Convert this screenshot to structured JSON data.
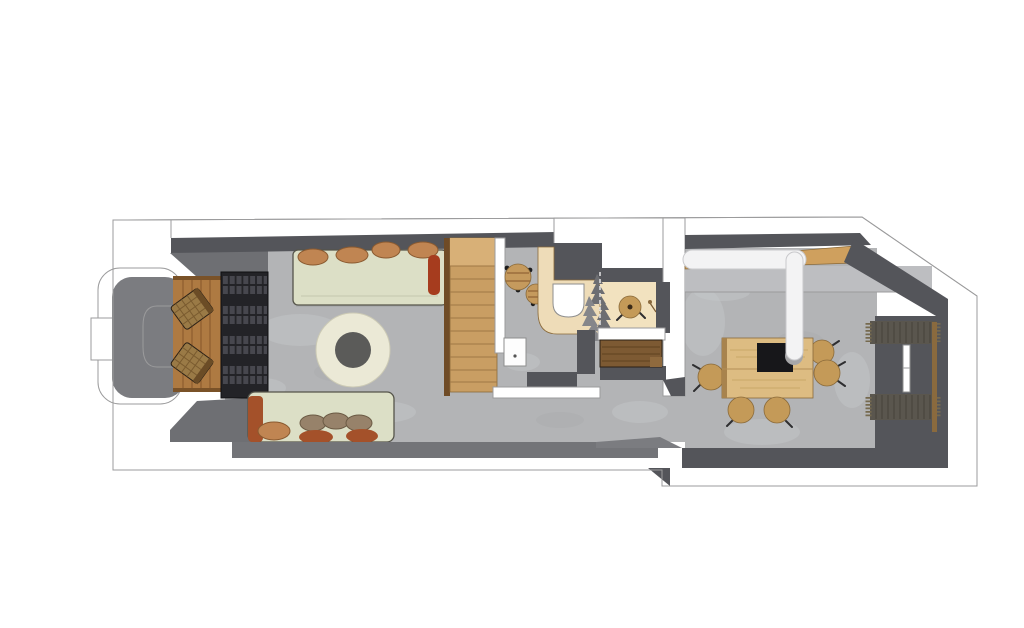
{
  "meta": {
    "type": "floor-plan",
    "style": "3d-top-down-render",
    "canvas": {
      "width": 1024,
      "height": 628
    }
  },
  "colors": {
    "white": "#FFFFFF",
    "outline_gray": "#9B9B9C",
    "wall_dark": "#54555A",
    "wall_mid": "#6E6F73",
    "wall_light": "#7B7C80",
    "wall_bottom": "#737478",
    "floor_concrete": "#B3B4B6",
    "floor_tex_light": "#C6C7C9",
    "floor_tex_dark": "#A7A8AA",
    "counter_gray": "#BDBEC1",
    "wood_strip": "#CFA05E",
    "wood_stairs": "#C99E63",
    "wood_stairs_light": "#D8B077",
    "wood_stringer": "#6F4B26",
    "wood_deck": "#AE7A42",
    "shelf_dark": "#232327",
    "shelf_cell": "#4B4B52",
    "sofa_cream": "#DCDFC6",
    "pillow_tan": "#C08552",
    "pillow_brown": "#97826A",
    "pillow_rust": "#A4512A",
    "bolster_red": "#A63C1E",
    "rug_cream": "#EBE9D6",
    "rug_center": "#5B5B59",
    "counter_wood": "#EEDCB8",
    "wood_floor_bath": "#F2E2BF",
    "table_wood": "#C59A5D",
    "stool_wood": "#C49A58",
    "bench_wood": "#7D5A33",
    "bench_wood_light": "#8F6A3E",
    "island_wood": "#DDBC82",
    "island_edge": "#A8834D",
    "stove_black": "#17171A",
    "duct_white": "#F3F3F4",
    "duct_shadow": "#A6A6A8",
    "radiator_dark": "#5A564E",
    "radiator_strip": "#8A6A3E",
    "plant_gray": "#85868A",
    "plant_gray_dark": "#6D6E72",
    "chair_rattan": "#9A7A46",
    "chair_rattan_dark": "#6B4C26",
    "appliance_white": "#FDFDFD",
    "leg_black": "#1C1C1E"
  },
  "rooms": [
    {
      "name": "entry-bay"
    },
    {
      "name": "lounge"
    },
    {
      "name": "staircase"
    },
    {
      "name": "bathroom"
    },
    {
      "name": "dining-kitchen"
    }
  ],
  "furniture": [
    {
      "name": "rattan-armchair",
      "count": 2
    },
    {
      "name": "shelving-unit",
      "count": 1
    },
    {
      "name": "sofa",
      "count": 2
    },
    {
      "name": "round-rug",
      "count": 1
    },
    {
      "name": "side-table",
      "count": 2
    },
    {
      "name": "vanity-counter-with-sink",
      "count": 1
    },
    {
      "name": "partition-plants",
      "count": 1
    },
    {
      "name": "bathroom-stool",
      "count": 1
    },
    {
      "name": "washing-machine",
      "count": 1
    },
    {
      "name": "wooden-bench",
      "count": 1
    },
    {
      "name": "kitchen-counter",
      "count": 1
    },
    {
      "name": "island-table-with-stove",
      "count": 1
    },
    {
      "name": "extractor-duct",
      "count": 1
    },
    {
      "name": "dining-stool",
      "count": 5
    },
    {
      "name": "radiator-panel",
      "count": 2
    }
  ]
}
